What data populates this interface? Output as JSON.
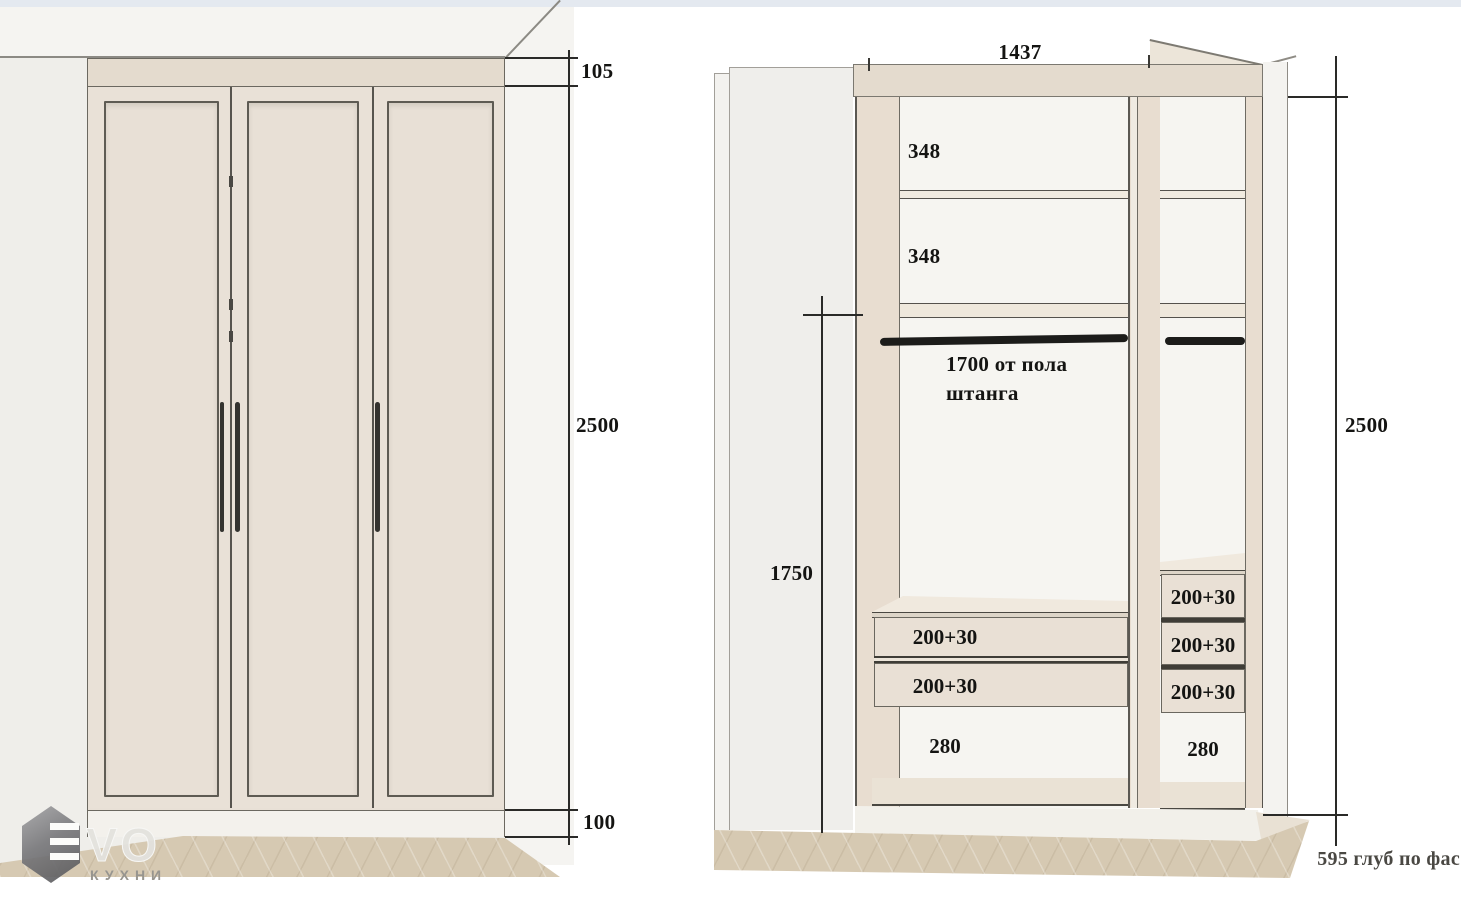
{
  "left_view": {
    "dim_top": "105",
    "dim_height": "2500",
    "dim_plinth": "100"
  },
  "right_view": {
    "dim_width": "1437",
    "shelf_gap_1": "348",
    "shelf_gap_2": "348",
    "rod_note_line1": "1700 от пола",
    "rod_note_line2": "штанга",
    "dim_left_height": "1750",
    "dim_height": "2500",
    "left_drawers": [
      "200+30",
      "200+30"
    ],
    "right_drawers": [
      "200+30",
      "200+30",
      "200+30"
    ],
    "left_bottom_gap": "280",
    "right_bottom_gap": "280",
    "depth_note": "595 глуб по фас"
  },
  "logo": {
    "wordmark": "VO",
    "subtitle": "КУХНИ"
  },
  "colors": {
    "band_beige": "#e4dbce",
    "door_face": "#e9e1d7",
    "interior_side": "#e8ddd0",
    "floor_wood": "#d6c9b2",
    "rod_black": "#1c1c1a",
    "dim_line": "#2a2a28",
    "wall_gray": "#efeeea"
  }
}
